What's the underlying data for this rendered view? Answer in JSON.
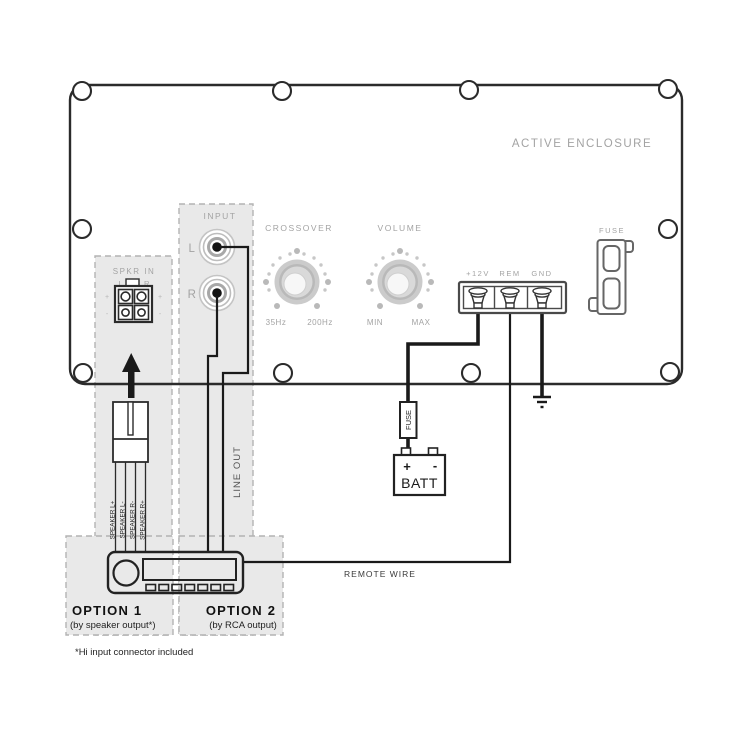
{
  "diagram": {
    "title": "ACTIVE ENCLOSURE",
    "panel": {
      "spkr_in": {
        "label": "SPKR IN",
        "left": "L",
        "right": "R",
        "plus": "+",
        "minus": "-"
      },
      "input": {
        "label": "INPUT",
        "left": "L",
        "right": "R"
      },
      "crossover": {
        "label": "CROSSOVER",
        "min_tick": "35Hz",
        "max_tick": "200Hz"
      },
      "volume": {
        "label": "VOLUME",
        "min_tick": "MIN",
        "max_tick": "MAX"
      },
      "terminals": [
        "+12V",
        "REM",
        "GND"
      ],
      "fuse_label": "FUSE"
    },
    "wiring": {
      "inline_fuse_label": "FUSE",
      "battery": {
        "label": "BATT",
        "plus": "+",
        "minus": "-"
      },
      "remote_wire_label": "REMOTE WIRE",
      "line_out_label": "LINE OUT",
      "speaker_wires": [
        "SPEAKER L+",
        "SPEAKER L-",
        "SPEAKER R-",
        "SPEAKER R+"
      ]
    },
    "options": {
      "option1": {
        "title": "OPTION 1",
        "subtitle": "(by speaker output*)"
      },
      "option2": {
        "title": "OPTION 2",
        "subtitle": "(by RCA output)"
      },
      "footnote": "*Hi input connector included"
    },
    "colors": {
      "line": "#2b2b2b",
      "panel_label": "#a3a3a3",
      "shade": "#e9e9e9",
      "dash_border": "#b3b3b3",
      "knob": "#bfbfbf"
    }
  }
}
